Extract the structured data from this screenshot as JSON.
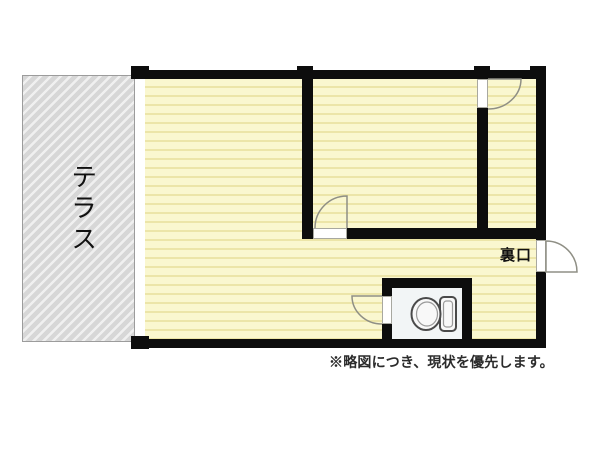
{
  "plan": {
    "terrace_label": "テラス",
    "back_door_label": "裏口",
    "note": "※略図につき、現状を優先します。"
  },
  "colors": {
    "wall": "#0d0d0d",
    "floor_base": "#faf7cf",
    "floor_stripe": "#ece5a8",
    "terrace_base": "#d7d7d7",
    "terrace_stripe": "#f0f0f0",
    "terrace_border": "#9c9c9c",
    "toilet_floor": "#f2f5f6",
    "door_line": "#8f8f85",
    "fixture_line": "#4a4a4a",
    "text": "#111111",
    "note_text": "#2b2b2b"
  }
}
